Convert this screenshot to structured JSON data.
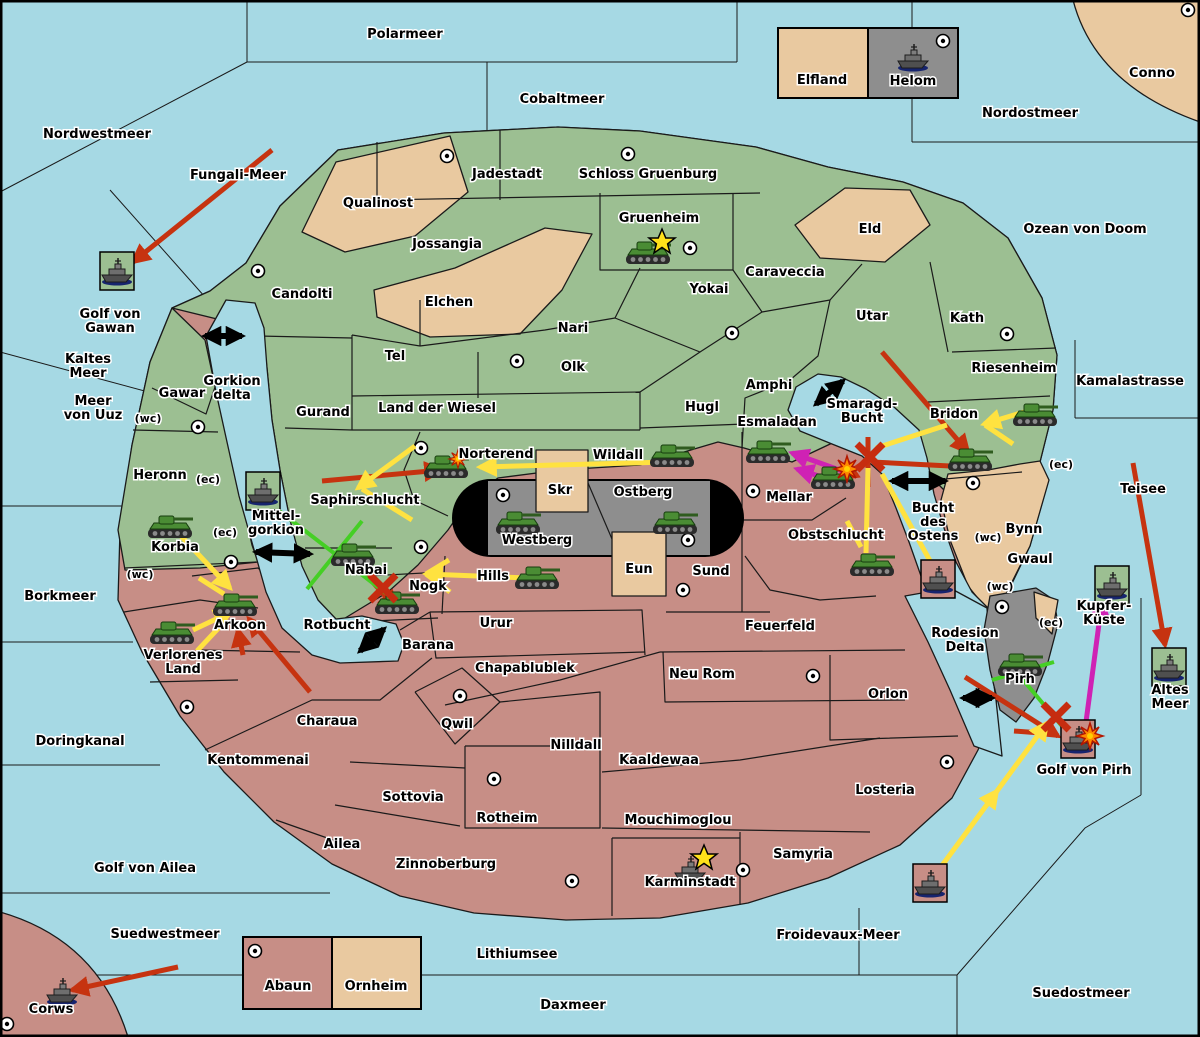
{
  "map": {
    "title": "Wargame strategy map",
    "colors": {
      "sea": "#a6d9e4",
      "green_land": "#9cbf92",
      "rose_land": "#c78e86",
      "tan_land": "#e9c9a0",
      "gray_land": "#8e8e8e",
      "attack_red": "#c63310",
      "move_yellow": "#ffe240",
      "support_green": "#45cf25",
      "convoy_magenta": "#cf22b4",
      "strait_black": "#000000"
    },
    "sea_labels": [
      {
        "text": "Polarmeer",
        "x": 405,
        "y": 38
      },
      {
        "text": "Cobaltmeer",
        "x": 562,
        "y": 103
      },
      {
        "text": "Nordostmeer",
        "x": 1030,
        "y": 117
      },
      {
        "text": "Nordwestmeer",
        "x": 97,
        "y": 138
      },
      {
        "text": "Fungali-Meer",
        "x": 238,
        "y": 179
      },
      {
        "text": "Ozean von Doom",
        "x": 1085,
        "y": 233
      },
      {
        "text": "Golf von\nGawan",
        "x": 110,
        "y": 325
      },
      {
        "text": "Kaltes\nMeer",
        "x": 88,
        "y": 370
      },
      {
        "text": "Meer\nvon Uuz",
        "x": 93,
        "y": 412
      },
      {
        "text": "Gorkion\ndelta",
        "x": 232,
        "y": 392
      },
      {
        "text": "Kamalastrasse",
        "x": 1130,
        "y": 385
      },
      {
        "text": "Smaragd-\nBucht",
        "x": 862,
        "y": 415
      },
      {
        "text": "Teisee",
        "x": 1143,
        "y": 493
      },
      {
        "text": "Bork​meer",
        "x": 60,
        "y": 600
      },
      {
        "text": "Mittel-\ngorkion",
        "x": 276,
        "y": 527
      },
      {
        "text": "Bucht\ndes\nOstens",
        "x": 933,
        "y": 526
      },
      {
        "text": "Kupfer-\nKüste",
        "x": 1104,
        "y": 617
      },
      {
        "text": "Altes\nMeer",
        "x": 1170,
        "y": 701
      },
      {
        "text": "Rotbucht",
        "x": 337,
        "y": 629
      },
      {
        "text": "Doringkanal",
        "x": 80,
        "y": 745
      },
      {
        "text": "Golf von Ailea",
        "x": 145,
        "y": 872
      },
      {
        "text": "Golf von Pirh",
        "x": 1084,
        "y": 774
      },
      {
        "text": "Rodesion\nDelta",
        "x": 965,
        "y": 644
      },
      {
        "text": "Froidevaux-Meer",
        "x": 838,
        "y": 939
      },
      {
        "text": "Suedwestmeer",
        "x": 165,
        "y": 938
      },
      {
        "text": "Lithiumsee",
        "x": 517,
        "y": 958
      },
      {
        "text": "Daxmeer",
        "x": 573,
        "y": 1009
      },
      {
        "text": "Suedostmeer",
        "x": 1081,
        "y": 997
      }
    ],
    "region_labels": [
      {
        "text": "Qualinost",
        "x": 378,
        "y": 207
      },
      {
        "text": "Jadestadt",
        "x": 507,
        "y": 178
      },
      {
        "text": "Schloss Gruenburg",
        "x": 648,
        "y": 178
      },
      {
        "text": "Gruenheim",
        "x": 659,
        "y": 222
      },
      {
        "text": "Caraveccia",
        "x": 785,
        "y": 276
      },
      {
        "text": "Yokai",
        "x": 709,
        "y": 293
      },
      {
        "text": "Jossangia",
        "x": 447,
        "y": 248
      },
      {
        "text": "Candolti",
        "x": 302,
        "y": 298
      },
      {
        "text": "Elchen",
        "x": 449,
        "y": 306
      },
      {
        "text": "Nari",
        "x": 573,
        "y": 332
      },
      {
        "text": "Olk",
        "x": 573,
        "y": 371
      },
      {
        "text": "Tel",
        "x": 395,
        "y": 360
      },
      {
        "text": "Gurand",
        "x": 323,
        "y": 416
      },
      {
        "text": "Land der Wiesel",
        "x": 437,
        "y": 412
      },
      {
        "text": "Hugl",
        "x": 702,
        "y": 411
      },
      {
        "text": "Amphi",
        "x": 769,
        "y": 389
      },
      {
        "text": "Utar",
        "x": 872,
        "y": 320
      },
      {
        "text": "Kath",
        "x": 967,
        "y": 322
      },
      {
        "text": "Eld",
        "x": 870,
        "y": 233
      },
      {
        "text": "Riesenheim",
        "x": 1014,
        "y": 372
      },
      {
        "text": "Bridon",
        "x": 954,
        "y": 418
      },
      {
        "text": "Esmaladan",
        "x": 777,
        "y": 426
      },
      {
        "text": "Norterend",
        "x": 496,
        "y": 458
      },
      {
        "text": "Wildall",
        "x": 618,
        "y": 459
      },
      {
        "text": "Skr",
        "x": 560,
        "y": 494
      },
      {
        "text": "Ostberg",
        "x": 643,
        "y": 496
      },
      {
        "text": "Westberg",
        "x": 537,
        "y": 544
      },
      {
        "text": "Mellar",
        "x": 789,
        "y": 501
      },
      {
        "text": "Saphirschlucht",
        "x": 365,
        "y": 504
      },
      {
        "text": "Heronn",
        "x": 160,
        "y": 479
      },
      {
        "text": "Gawar",
        "x": 182,
        "y": 397
      },
      {
        "text": "Korbia",
        "x": 175,
        "y": 551
      },
      {
        "text": "Nabai",
        "x": 366,
        "y": 574
      },
      {
        "text": "Nogk",
        "x": 428,
        "y": 590
      },
      {
        "text": "Hills",
        "x": 493,
        "y": 580
      },
      {
        "text": "Eun",
        "x": 639,
        "y": 573
      },
      {
        "text": "Sund",
        "x": 711,
        "y": 575
      },
      {
        "text": "Obstschlucht",
        "x": 836,
        "y": 539
      },
      {
        "text": "Bynn",
        "x": 1024,
        "y": 533
      },
      {
        "text": "Gwaul",
        "x": 1030,
        "y": 563
      },
      {
        "text": "Urur",
        "x": 496,
        "y": 627
      },
      {
        "text": "Barana",
        "x": 428,
        "y": 649
      },
      {
        "text": "Feuerfeld",
        "x": 780,
        "y": 630
      },
      {
        "text": "Chapablublek",
        "x": 525,
        "y": 672
      },
      {
        "text": "Neu Rom",
        "x": 702,
        "y": 678
      },
      {
        "text": "Qwil",
        "x": 457,
        "y": 728
      },
      {
        "text": "Nilldall",
        "x": 576,
        "y": 749
      },
      {
        "text": "Kaaldewaa",
        "x": 659,
        "y": 764
      },
      {
        "text": "Orlon",
        "x": 888,
        "y": 698
      },
      {
        "text": "Arkoon",
        "x": 240,
        "y": 629
      },
      {
        "text": "Verlorenes\nLand",
        "x": 183,
        "y": 666
      },
      {
        "text": "Charaua",
        "x": 327,
        "y": 725
      },
      {
        "text": "Kentommenai",
        "x": 258,
        "y": 764
      },
      {
        "text": "Sottovia",
        "x": 413,
        "y": 801
      },
      {
        "text": "Rotheim",
        "x": 507,
        "y": 822
      },
      {
        "text": "Mouchimoglou",
        "x": 678,
        "y": 824
      },
      {
        "text": "Losteria",
        "x": 885,
        "y": 794
      },
      {
        "text": "Ailea",
        "x": 342,
        "y": 848
      },
      {
        "text": "Zinnoberburg",
        "x": 446,
        "y": 868
      },
      {
        "text": "Karminstadt",
        "x": 690,
        "y": 886
      },
      {
        "text": "Samyria",
        "x": 803,
        "y": 858
      },
      {
        "text": "Pirh",
        "x": 1020,
        "y": 683
      },
      {
        "text": "Corws",
        "x": 51,
        "y": 1013
      },
      {
        "text": "Abaun",
        "x": 288,
        "y": 990
      },
      {
        "text": "Ornheim",
        "x": 376,
        "y": 990
      },
      {
        "text": "Elfland",
        "x": 822,
        "y": 84
      },
      {
        "text": "Helom",
        "x": 913,
        "y": 85
      },
      {
        "text": "Conno",
        "x": 1152,
        "y": 77
      }
    ],
    "coast_labels": [
      {
        "text": "(wc)",
        "x": 148,
        "y": 422
      },
      {
        "text": "(ec)",
        "x": 208,
        "y": 483
      },
      {
        "text": "(ec)",
        "x": 225,
        "y": 536
      },
      {
        "text": "(wc)",
        "x": 140,
        "y": 578
      },
      {
        "text": "(ec)",
        "x": 1061,
        "y": 468
      },
      {
        "text": "(wc)",
        "x": 988,
        "y": 541
      },
      {
        "text": "(wc)",
        "x": 1000,
        "y": 590
      },
      {
        "text": "(ec)",
        "x": 1051,
        "y": 626
      }
    ],
    "supply_centers": [
      [
        447,
        156
      ],
      [
        628,
        154
      ],
      [
        690,
        248
      ],
      [
        258,
        271
      ],
      [
        1188,
        10
      ],
      [
        943,
        41
      ],
      [
        517,
        361
      ],
      [
        732,
        333
      ],
      [
        1007,
        334
      ],
      [
        198,
        427
      ],
      [
        421,
        448
      ],
      [
        231,
        562
      ],
      [
        421,
        547
      ],
      [
        753,
        491
      ],
      [
        503,
        495
      ],
      [
        688,
        540
      ],
      [
        683,
        590
      ],
      [
        973,
        483
      ],
      [
        187,
        707
      ],
      [
        460,
        696
      ],
      [
        494,
        779
      ],
      [
        572,
        881
      ],
      [
        743,
        870
      ],
      [
        813,
        676
      ],
      [
        947,
        762
      ],
      [
        7,
        1024
      ],
      [
        255,
        951
      ],
      [
        1002,
        607
      ]
    ],
    "units": [
      {
        "type": "tank",
        "x": 648,
        "y": 253
      },
      {
        "type": "tank",
        "x": 446,
        "y": 467
      },
      {
        "type": "tank",
        "x": 672,
        "y": 456
      },
      {
        "type": "tank",
        "x": 768,
        "y": 452
      },
      {
        "type": "tank",
        "x": 833,
        "y": 478
      },
      {
        "type": "tank",
        "x": 970,
        "y": 460
      },
      {
        "type": "tank",
        "x": 1035,
        "y": 415
      },
      {
        "type": "tank",
        "x": 518,
        "y": 523
      },
      {
        "type": "tank",
        "x": 675,
        "y": 523
      },
      {
        "type": "tank",
        "x": 537,
        "y": 578
      },
      {
        "type": "tank",
        "x": 353,
        "y": 555
      },
      {
        "type": "tank",
        "x": 397,
        "y": 603
      },
      {
        "type": "tank",
        "x": 170,
        "y": 527
      },
      {
        "type": "tank",
        "x": 235,
        "y": 605
      },
      {
        "type": "tank",
        "x": 172,
        "y": 633
      },
      {
        "type": "tank",
        "x": 872,
        "y": 565
      },
      {
        "type": "tank",
        "x": 1020,
        "y": 665
      },
      {
        "type": "ship",
        "x": 117,
        "y": 272,
        "box": "green"
      },
      {
        "type": "ship",
        "x": 913,
        "y": 58
      },
      {
        "type": "ship",
        "x": 263,
        "y": 492,
        "box": "green"
      },
      {
        "type": "ship",
        "x": 938,
        "y": 580,
        "box": "rose"
      },
      {
        "type": "ship",
        "x": 1078,
        "y": 740,
        "box": "rose"
      },
      {
        "type": "ship",
        "x": 1112,
        "y": 586,
        "box": "green"
      },
      {
        "type": "ship",
        "x": 1169,
        "y": 668,
        "box": "green"
      },
      {
        "type": "ship",
        "x": 930,
        "y": 884,
        "box": "rose"
      },
      {
        "type": "ship",
        "x": 690,
        "y": 870
      },
      {
        "type": "ship",
        "x": 62,
        "y": 992
      }
    ],
    "arrows": [
      {
        "color": "red",
        "x1": 272,
        "y1": 150,
        "x2": 133,
        "y2": 262,
        "head": "end"
      },
      {
        "color": "red",
        "x1": 178,
        "y1": 967,
        "x2": 72,
        "y2": 990,
        "head": "end"
      },
      {
        "color": "red",
        "x1": 322,
        "y1": 481,
        "x2": 441,
        "y2": 470,
        "head": "end"
      },
      {
        "color": "red",
        "x1": 360,
        "y1": 568,
        "x2": 396,
        "y2": 608,
        "head": "end"
      },
      {
        "color": "red",
        "x1": 310,
        "y1": 692,
        "x2": 249,
        "y2": 619,
        "head": "end"
      },
      {
        "color": "red",
        "x1": 243,
        "y1": 655,
        "x2": 238,
        "y2": 630,
        "head": "end"
      },
      {
        "color": "red",
        "x1": 882,
        "y1": 352,
        "x2": 968,
        "y2": 452,
        "head": "end"
      },
      {
        "color": "red",
        "x1": 872,
        "y1": 462,
        "x2": 950,
        "y2": 466,
        "head": "none"
      },
      {
        "color": "red",
        "x1": 868,
        "y1": 437,
        "x2": 868,
        "y2": 487,
        "head": "none"
      },
      {
        "color": "red",
        "x1": 868,
        "y1": 460,
        "x2": 841,
        "y2": 478,
        "head": "end"
      },
      {
        "color": "red",
        "x1": 1133,
        "y1": 463,
        "x2": 1165,
        "y2": 645,
        "head": "end"
      },
      {
        "color": "red",
        "x1": 965,
        "y1": 677,
        "x2": 1058,
        "y2": 736,
        "head": "end"
      },
      {
        "color": "red",
        "x1": 1014,
        "y1": 731,
        "x2": 1054,
        "y2": 734,
        "head": "none"
      },
      {
        "color": "yellow",
        "x1": 668,
        "y1": 462,
        "x2": 480,
        "y2": 467,
        "head": "end"
      },
      {
        "color": "yellow",
        "x1": 415,
        "y1": 446,
        "x2": 358,
        "y2": 488,
        "head": "end"
      },
      {
        "color": "yellow",
        "x1": 412,
        "y1": 520,
        "x2": 362,
        "y2": 489,
        "head": "none"
      },
      {
        "color": "yellow",
        "x1": 528,
        "y1": 578,
        "x2": 426,
        "y2": 574,
        "head": "end"
      },
      {
        "color": "yellow",
        "x1": 449,
        "y1": 560,
        "x2": 426,
        "y2": 574,
        "head": "none"
      },
      {
        "color": "yellow",
        "x1": 450,
        "y1": 592,
        "x2": 426,
        "y2": 574,
        "head": "none"
      },
      {
        "color": "yellow",
        "x1": 181,
        "y1": 536,
        "x2": 230,
        "y2": 588,
        "head": "end"
      },
      {
        "color": "yellow",
        "x1": 199,
        "y1": 578,
        "x2": 224,
        "y2": 594,
        "head": "none"
      },
      {
        "color": "yellow",
        "x1": 193,
        "y1": 630,
        "x2": 231,
        "y2": 612,
        "head": "end"
      },
      {
        "color": "yellow",
        "x1": 197,
        "y1": 651,
        "x2": 227,
        "y2": 619,
        "head": "none"
      },
      {
        "color": "yellow",
        "x1": 1024,
        "y1": 412,
        "x2": 984,
        "y2": 424,
        "head": "end"
      },
      {
        "color": "yellow",
        "x1": 1013,
        "y1": 444,
        "x2": 985,
        "y2": 425,
        "head": "none"
      },
      {
        "color": "yellow",
        "x1": 876,
        "y1": 448,
        "x2": 947,
        "y2": 425,
        "head": "none"
      },
      {
        "color": "yellow",
        "x1": 868,
        "y1": 468,
        "x2": 866,
        "y2": 553,
        "head": "none"
      },
      {
        "color": "yellow",
        "x1": 847,
        "y1": 521,
        "x2": 861,
        "y2": 547,
        "head": "none"
      },
      {
        "color": "yellow",
        "x1": 934,
        "y1": 568,
        "x2": 882,
        "y2": 474,
        "head": "none"
      },
      {
        "color": "yellow",
        "x1": 935,
        "y1": 875,
        "x2": 997,
        "y2": 791,
        "head": "end"
      },
      {
        "color": "yellow",
        "x1": 997,
        "y1": 791,
        "x2": 1047,
        "y2": 723,
        "head": "end"
      },
      {
        "color": "green",
        "x1": 269,
        "y1": 503,
        "x2": 396,
        "y2": 601,
        "head": "none"
      },
      {
        "color": "green",
        "x1": 362,
        "y1": 521,
        "x2": 307,
        "y2": 589,
        "head": "none"
      },
      {
        "color": "green",
        "x1": 1008,
        "y1": 662,
        "x2": 1066,
        "y2": 731,
        "head": "none"
      },
      {
        "color": "green",
        "x1": 992,
        "y1": 680,
        "x2": 1054,
        "y2": 662,
        "head": "none"
      },
      {
        "color": "magenta",
        "x1": 845,
        "y1": 472,
        "x2": 792,
        "y2": 453,
        "head": "end"
      },
      {
        "color": "magenta",
        "x1": 850,
        "y1": 486,
        "x2": 797,
        "y2": 469,
        "head": "end"
      },
      {
        "color": "magenta",
        "x1": 1086,
        "y1": 722,
        "x2": 1102,
        "y2": 601,
        "head": "end"
      },
      {
        "color": "black",
        "x1": 205,
        "y1": 336,
        "x2": 242,
        "y2": 336,
        "head": "both"
      },
      {
        "color": "black",
        "x1": 256,
        "y1": 552,
        "x2": 310,
        "y2": 554,
        "head": "both"
      },
      {
        "color": "black",
        "x1": 816,
        "y1": 404,
        "x2": 843,
        "y2": 381,
        "head": "both"
      },
      {
        "color": "black",
        "x1": 892,
        "y1": 481,
        "x2": 945,
        "y2": 481,
        "head": "both"
      },
      {
        "color": "black",
        "x1": 360,
        "y1": 651,
        "x2": 384,
        "y2": 629,
        "head": "both"
      },
      {
        "color": "black",
        "x1": 963,
        "y1": 698,
        "x2": 992,
        "y2": 698,
        "head": "both"
      }
    ],
    "markers": [
      {
        "type": "star",
        "x": 662,
        "y": 242
      },
      {
        "type": "star",
        "x": 704,
        "y": 858
      },
      {
        "type": "burst",
        "x": 458,
        "y": 459,
        "s": 0.7
      },
      {
        "type": "burst",
        "x": 847,
        "y": 469
      },
      {
        "type": "burst",
        "x": 1090,
        "y": 736
      },
      {
        "type": "xmark",
        "x": 383,
        "y": 588
      },
      {
        "type": "xmark",
        "x": 870,
        "y": 457
      },
      {
        "type": "xmark",
        "x": 1056,
        "y": 717
      }
    ],
    "legend": {
      "top_left": "Elfland",
      "top_right": "Helom",
      "bottom_left": "Abaun",
      "bottom_right": "Ornheim"
    }
  }
}
